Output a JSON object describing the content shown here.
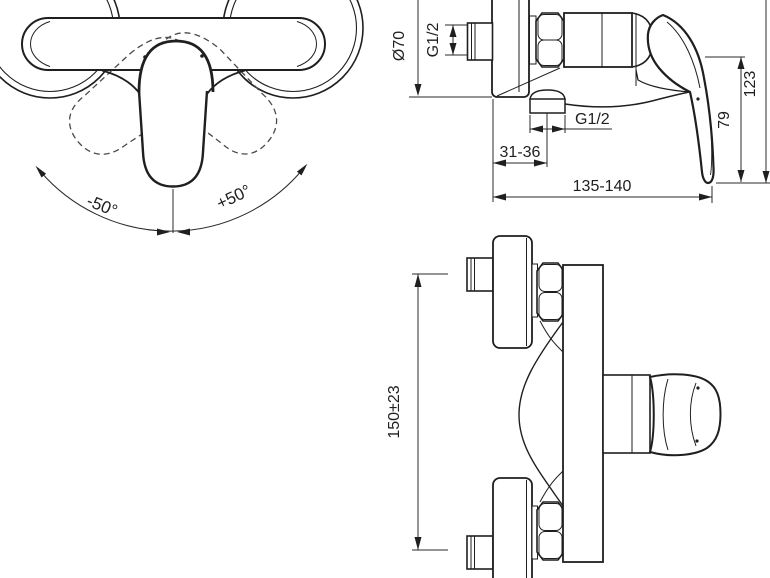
{
  "drawing": {
    "background_color": "#ffffff",
    "line_color": "#1f1f1f",
    "views": {
      "front": {
        "description": "front view with handle swing angles",
        "angle_left": "-50°",
        "angle_right": "+50°"
      },
      "side": {
        "escutcheon_diameter": "Ø70",
        "inlet_thread_size": "G1/2",
        "outlet_thread_size": "G1/2",
        "wall_to_outlet": "31-36",
        "overall_width": "135-140",
        "handle_projection": "79",
        "overall_height": "123"
      },
      "top": {
        "connection_spacing": "150±23"
      }
    }
  }
}
